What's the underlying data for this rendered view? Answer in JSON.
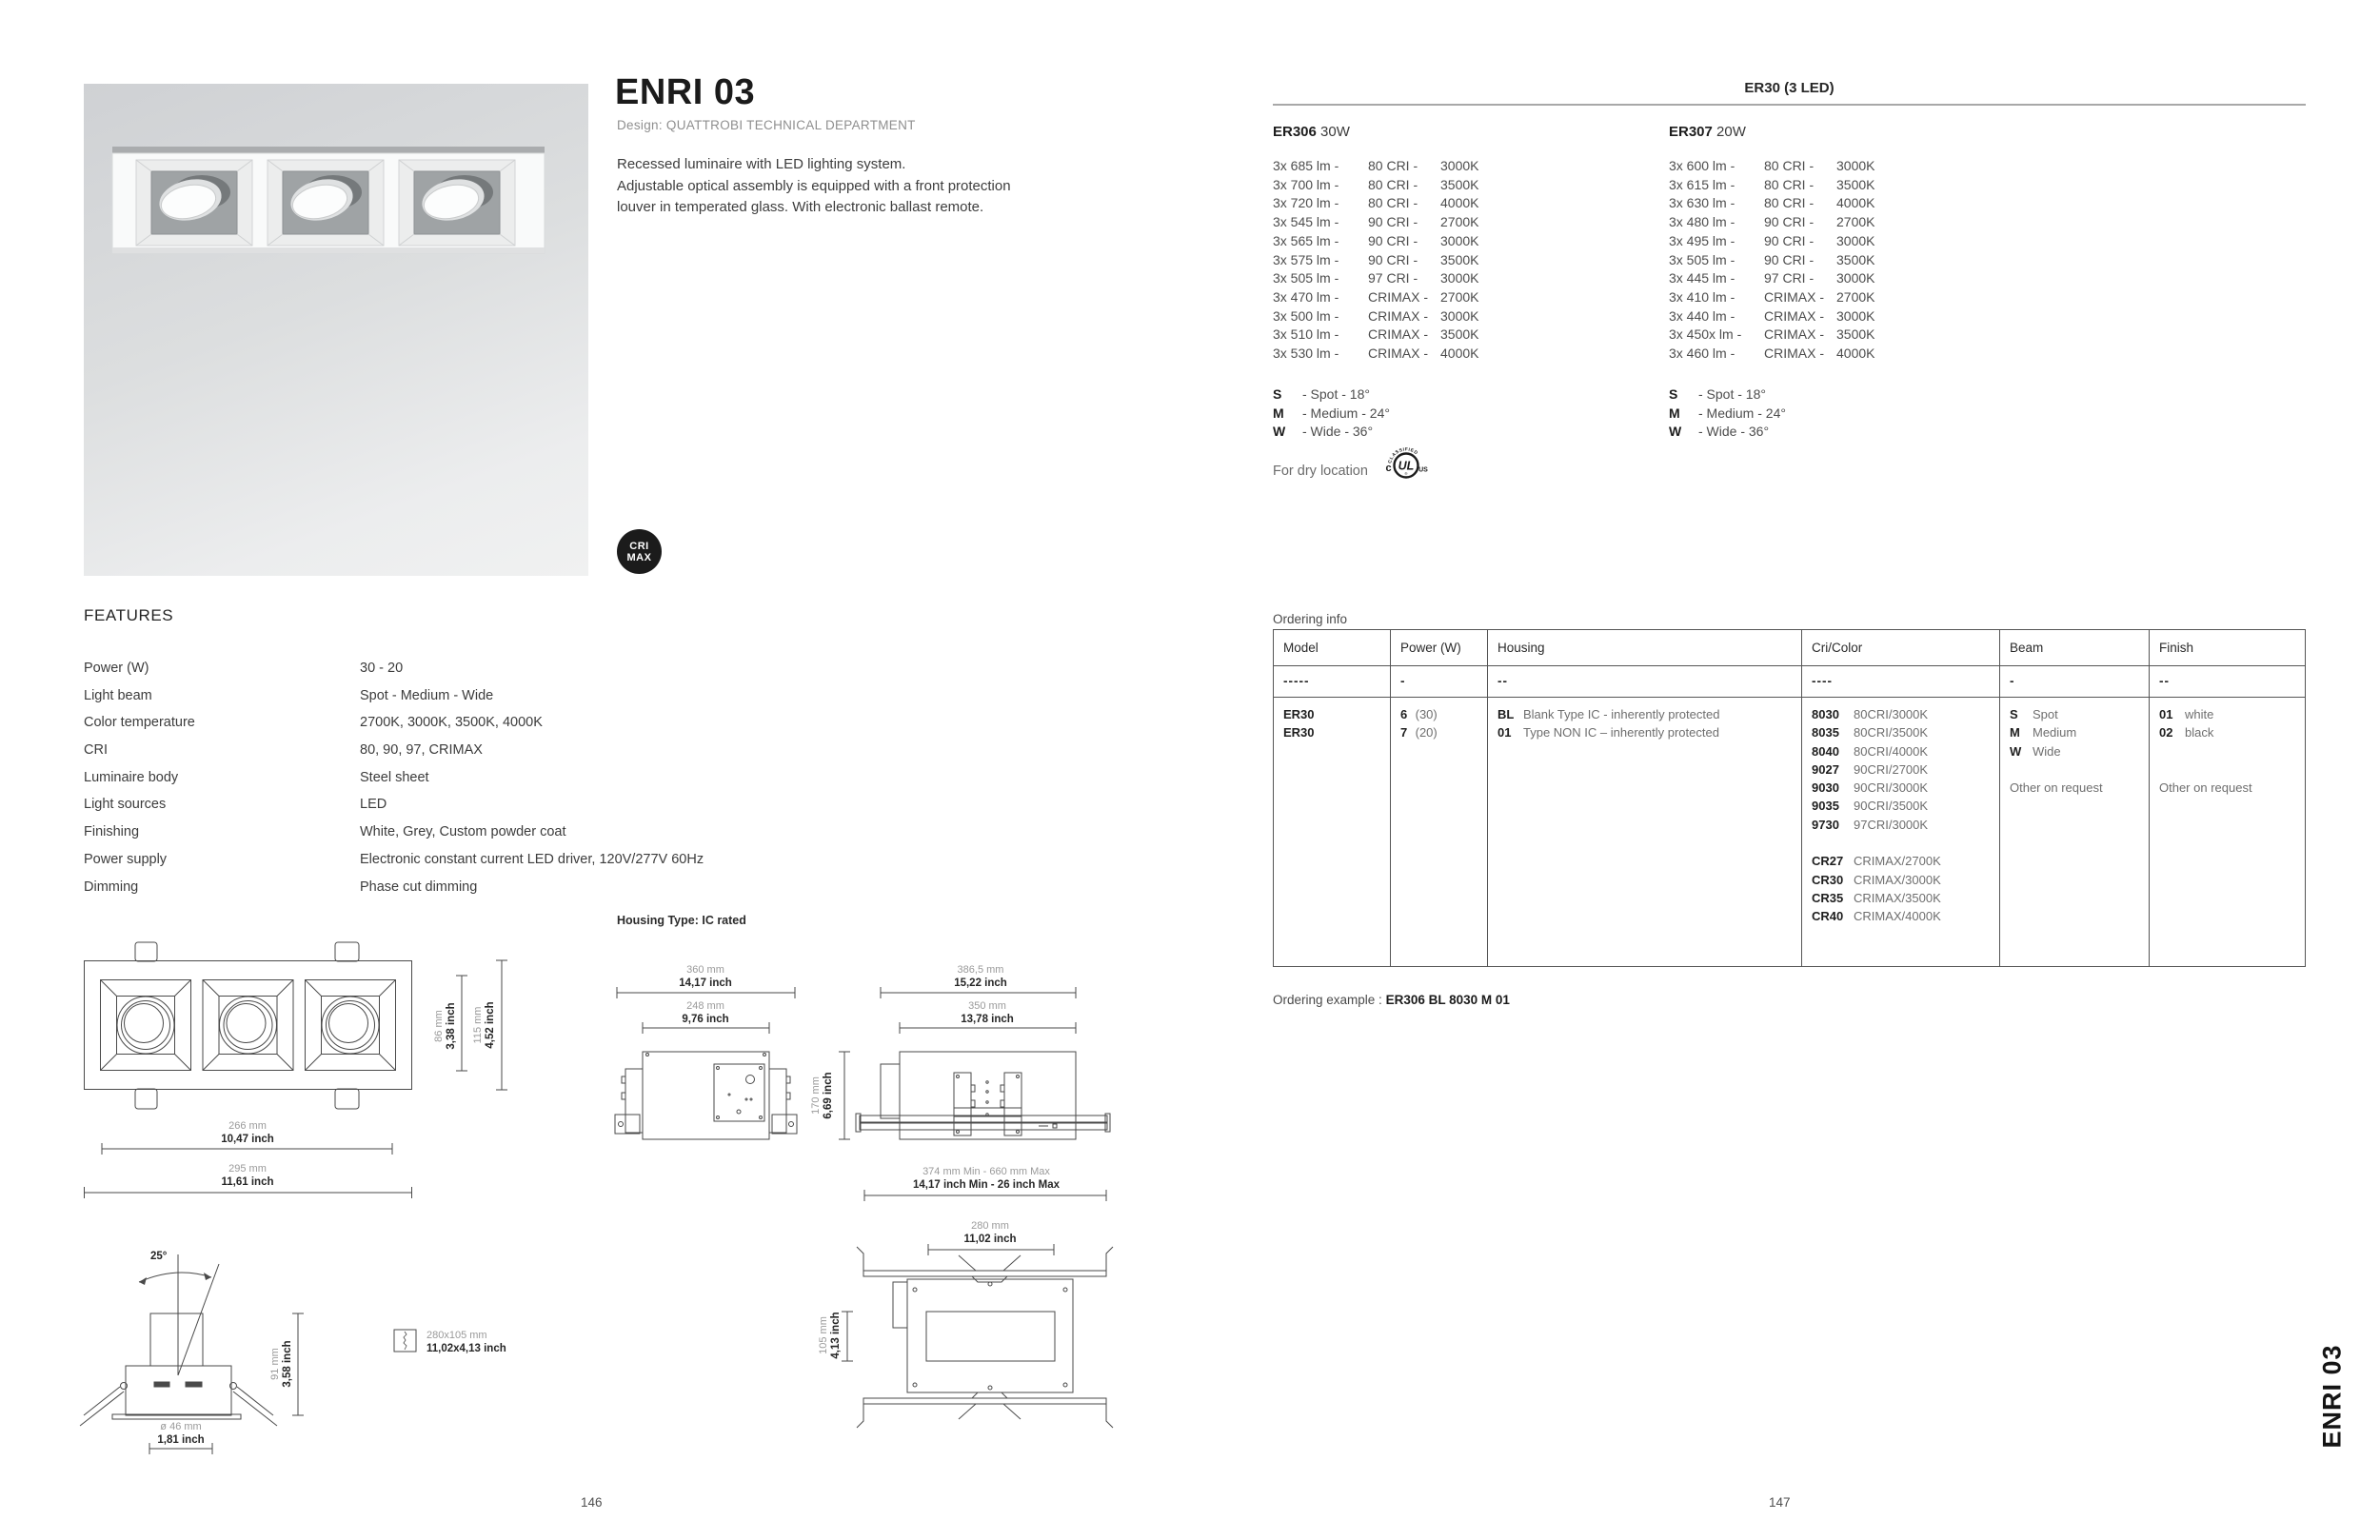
{
  "page": {
    "left_number": "146",
    "right_number": "147",
    "side_tab": "ENRI 03"
  },
  "product": {
    "title": "ENRI 03",
    "design_credit": "Design: QUATTROBI TECHNICAL DEPARTMENT",
    "description_lines": [
      "Recessed luminaire with LED lighting system.",
      "Adjustable optical assembly is equipped with a front protection",
      "louver in temperated glass. With electronic ballast remote."
    ],
    "badge_line1": "CRI",
    "badge_line2": "MAX"
  },
  "features": {
    "heading": "FEATURES",
    "rows": [
      {
        "label": "Power (W)",
        "value": "30 - 20"
      },
      {
        "label": "Light beam",
        "value": "Spot - Medium - Wide"
      },
      {
        "label": "Color temperature",
        "value": "2700K, 3000K, 3500K, 4000K"
      },
      {
        "label": "CRI",
        "value": "80, 90, 97, CRIMAX"
      },
      {
        "label": "Luminaire body",
        "value": "Steel sheet"
      },
      {
        "label": "Light sources",
        "value": "LED"
      },
      {
        "label": "Finishing",
        "value": "White, Grey, Custom powder coat"
      },
      {
        "label": "Power supply",
        "value": "Electronic constant current LED driver, 120V/277V 60Hz"
      },
      {
        "label": "Dimming",
        "value": "Phase cut dimming"
      }
    ]
  },
  "specs": {
    "group_header": "ER30 (3 LED)",
    "model_a": {
      "code": "ER306",
      "power": " 30W",
      "outputs": [
        [
          "3x 685 lm -",
          "80 CRI -",
          "3000K"
        ],
        [
          "3x 700 lm -",
          "80 CRI -",
          "3500K"
        ],
        [
          "3x 720 lm -",
          "80 CRI -",
          "4000K"
        ],
        [
          "3x 545 lm -",
          "90 CRI -",
          "2700K"
        ],
        [
          "3x 565 lm -",
          "90 CRI -",
          "3000K"
        ],
        [
          "3x 575 lm -",
          "90 CRI -",
          "3500K"
        ],
        [
          "3x 505 lm -",
          "97 CRI -",
          "3000K"
        ],
        [
          "3x 470 lm -",
          "CRIMAX -",
          "2700K"
        ],
        [
          "3x 500 lm -",
          "CRIMAX -",
          "3000K"
        ],
        [
          "3x 510 lm -",
          "CRIMAX -",
          "3500K"
        ],
        [
          "3x 530 lm -",
          "CRIMAX -",
          "4000K"
        ]
      ]
    },
    "model_b": {
      "code": "ER307",
      "power": " 20W",
      "outputs": [
        [
          "3x 600 lm -",
          "80 CRI -",
          "3000K"
        ],
        [
          "3x 615 lm -",
          "80 CRI -",
          "3500K"
        ],
        [
          "3x 630 lm -",
          "80 CRI -",
          "4000K"
        ],
        [
          "3x 480 lm -",
          "90 CRI -",
          "2700K"
        ],
        [
          "3x 495 lm -",
          "90 CRI -",
          "3000K"
        ],
        [
          "3x 505 lm -",
          "90 CRI -",
          "3500K"
        ],
        [
          "3x 445 lm -",
          "97 CRI -",
          "3000K"
        ],
        [
          "3x 410 lm -",
          "CRIMAX -",
          "2700K"
        ],
        [
          "3x 440 lm -",
          "CRIMAX -",
          "3000K"
        ],
        [
          "3x 450x lm -",
          "CRIMAX -",
          "3500K"
        ],
        [
          "3x 460 lm -",
          "CRIMAX -",
          "4000K"
        ]
      ]
    },
    "beams": [
      {
        "key": "S",
        "desc": "- Spot - 18°"
      },
      {
        "key": "M",
        "desc": "- Medium - 24°"
      },
      {
        "key": "W",
        "desc": "- Wide - 36°"
      }
    ],
    "dry_location_note": "For dry location",
    "ul": {
      "arc": "CLASSIFIED",
      "c": "c",
      "ul": "UL",
      "us": "US",
      "r": "®"
    }
  },
  "ordering": {
    "section_label": "Ordering info",
    "example_label": "Ordering example : ",
    "example_value": "ER306 BL 8030 M 01",
    "columns": [
      "Model",
      "Power (W)",
      "Housing",
      "Cri/Color",
      "Beam",
      "Finish"
    ],
    "dashes": [
      "-----",
      "-",
      "--",
      "----",
      "-",
      "--"
    ],
    "model_lines": [
      {
        "b": "ER30",
        "r": ""
      },
      {
        "b": "ER30",
        "r": ""
      }
    ],
    "power_lines": [
      {
        "b": "6",
        "r": " (30)"
      },
      {
        "b": "7",
        "r": " (20)"
      }
    ],
    "housing_lines": [
      {
        "b": "BL",
        "r": "Blank Type IC - inherently protected"
      },
      {
        "b": "01",
        "r": "Type NON IC – inherently protected"
      }
    ],
    "cricolor_lines": [
      {
        "b": "8030",
        "r": "80CRI/3000K"
      },
      {
        "b": "8035",
        "r": "80CRI/3500K"
      },
      {
        "b": "8040",
        "r": "80CRI/4000K"
      },
      {
        "b": "9027",
        "r": "90CRI/2700K"
      },
      {
        "b": "9030",
        "r": "90CRI/3000K"
      },
      {
        "b": "9035",
        "r": "90CRI/3500K"
      },
      {
        "b": "9730",
        "r": "97CRI/3000K"
      },
      {
        "b": "",
        "r": ""
      },
      {
        "b": "CR27",
        "r": "CRIMAX/2700K"
      },
      {
        "b": "CR30",
        "r": "CRIMAX/3000K"
      },
      {
        "b": "CR35",
        "r": "CRIMAX/3500K"
      },
      {
        "b": "CR40",
        "r": "CRIMAX/4000K"
      }
    ],
    "beam_lines": [
      {
        "b": "S",
        "r": "Spot"
      },
      {
        "b": "M",
        "r": "Medium"
      },
      {
        "b": "W",
        "r": "Wide"
      },
      {
        "b": "",
        "r": ""
      },
      {
        "b": "",
        "r": "Other on request"
      }
    ],
    "finish_lines": [
      {
        "b": "01",
        "r": "white"
      },
      {
        "b": "02",
        "r": "black"
      },
      {
        "b": "",
        "r": ""
      },
      {
        "b": "",
        "r": ""
      },
      {
        "b": "",
        "r": "Other on request"
      }
    ]
  },
  "drawings": {
    "housing_type_label": "Housing Type: IC rated",
    "plan": {
      "h1_mm": "86 mm",
      "h1_in": "3,38 inch",
      "h2_mm": "115 mm",
      "h2_in": "4,52 inch",
      "w1_mm": "266 mm",
      "w1_in": "10,47 inch",
      "w2_mm": "295 mm",
      "w2_in": "11,61 inch"
    },
    "housing_top": {
      "w1_mm": "360 mm",
      "w1_in": "14,17 inch",
      "w2_mm": "248 mm",
      "w2_in": "9,76 inch",
      "h_mm": "170 mm",
      "h_in": "6,69 inch"
    },
    "housing_side": {
      "w1_mm": "386,5 mm",
      "w1_in": "15,22 inch",
      "w2_mm": "350 mm",
      "w2_in": "13,78 inch",
      "range_mm": "374 mm Min - 660 mm Max",
      "range_in": "14,17 inch Min - 26 inch Max"
    },
    "section": {
      "angle": "25°",
      "h_mm": "91 mm",
      "h_in": "3,58 inch",
      "d_mm": "ø 46 mm",
      "d_in": "1,81 inch"
    },
    "cutout": {
      "mm": "280x105 mm",
      "in": "11,02x4,13 inch"
    },
    "bottom_view": {
      "w_mm": "280 mm",
      "w_in": "11,02 inch",
      "h_mm": "105 mm",
      "h_in": "4,13 inch"
    }
  }
}
